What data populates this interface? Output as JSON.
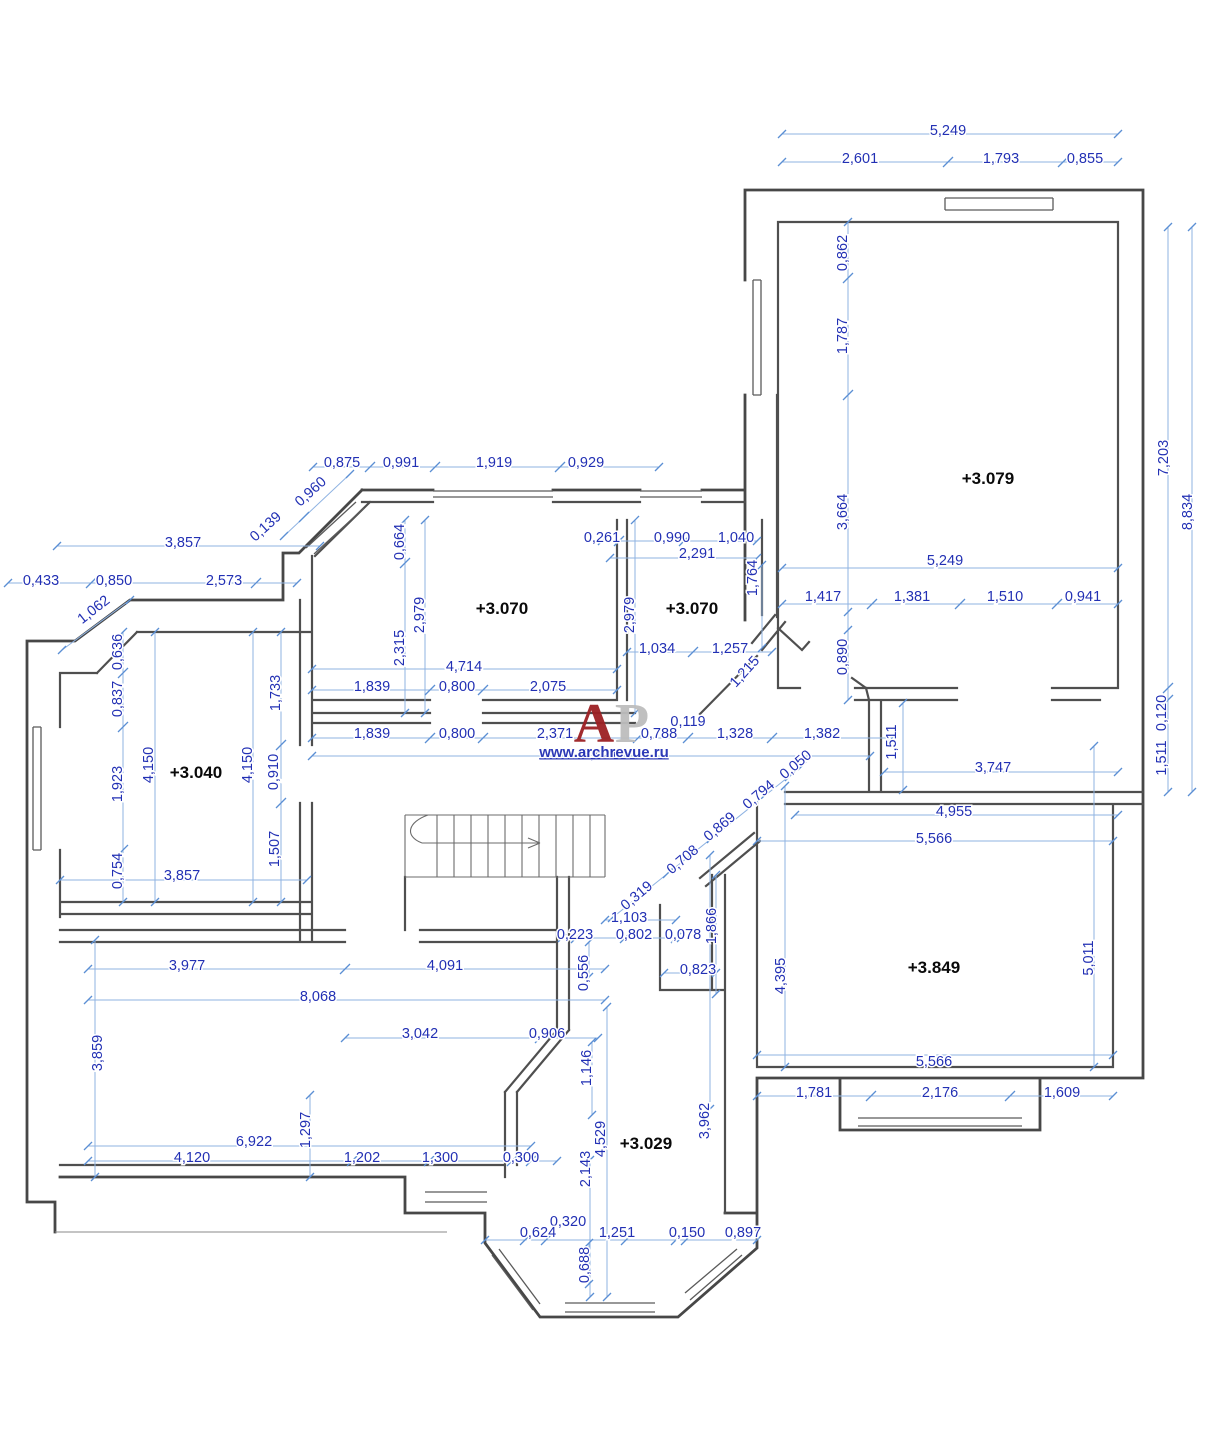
{
  "drawing": {
    "type": "architectural-floor-plan",
    "units_note": "dimensions in metres with comma decimal separator",
    "accent_color": "#2230b4",
    "dim_line_color": "#8fb3e2",
    "wall_color": "#4f4f4f"
  },
  "rooms": {
    "levels": [
      "+3.079",
      "+3.070",
      "+3.070",
      "+3.040",
      "+3.849",
      "+3.029"
    ]
  },
  "dims": {
    "ur": [
      "5,249",
      "2,601",
      "1,793",
      "0,855",
      "0,862",
      "1,787",
      "3,664",
      "7,203",
      "8,834",
      "5,249",
      "1,417",
      "1,381",
      "1,510",
      "0,941",
      "0,890"
    ],
    "re": [
      "0,120",
      "1,511"
    ],
    "hr": [
      "1,511",
      "3,747",
      "4,955"
    ],
    "tm": [
      "0,875",
      "0,991",
      "1,919",
      "0,929",
      "0,960",
      "0,139",
      "3,857",
      "0,433",
      "0,850",
      "2,573",
      "1,062"
    ],
    "r70l": [
      "0,664",
      "2,979",
      "2,315",
      "4,714",
      "1,839",
      "0,800",
      "2,075",
      "1,839",
      "0,800",
      "2,371",
      "0,788",
      "1,328",
      "1,382",
      "0,119",
      "8,621"
    ],
    "r70r": [
      "0,261",
      "0,990",
      "1,040",
      "2,291",
      "1,764",
      "2,979",
      "1,034",
      "1,257",
      "1,215"
    ],
    "r40": [
      "0,636",
      "0,837",
      "1,923",
      "0,754",
      "4,150",
      "4,150",
      "1,733",
      "0,910",
      "1,507",
      "3,857"
    ],
    "lv": [
      "3,977",
      "4,091",
      "8,068",
      "3,859",
      "3,042",
      "0,906",
      "1,146",
      "0,556",
      "0,223",
      "6,922",
      "1,297",
      "4,120",
      "1,202",
      "1,300",
      "0,300"
    ],
    "hc": [
      "1,103",
      "0,802",
      "0,078",
      "1,866",
      "0,823",
      "0,319",
      "0,708",
      "0,869",
      "0,794",
      "0,050"
    ],
    "r29": [
      "4,529",
      "2,143",
      "3,962",
      "0,320",
      "0,624",
      "1,251",
      "0,150",
      "0,897",
      "0,688"
    ],
    "r49": [
      "5,566",
      "4,395",
      "5,011",
      "5,566",
      "1,781",
      "2,176",
      "1,609"
    ]
  },
  "watermark": {
    "letter_a": "А",
    "letter_p": "Р",
    "site": "www.archrevue.ru"
  }
}
